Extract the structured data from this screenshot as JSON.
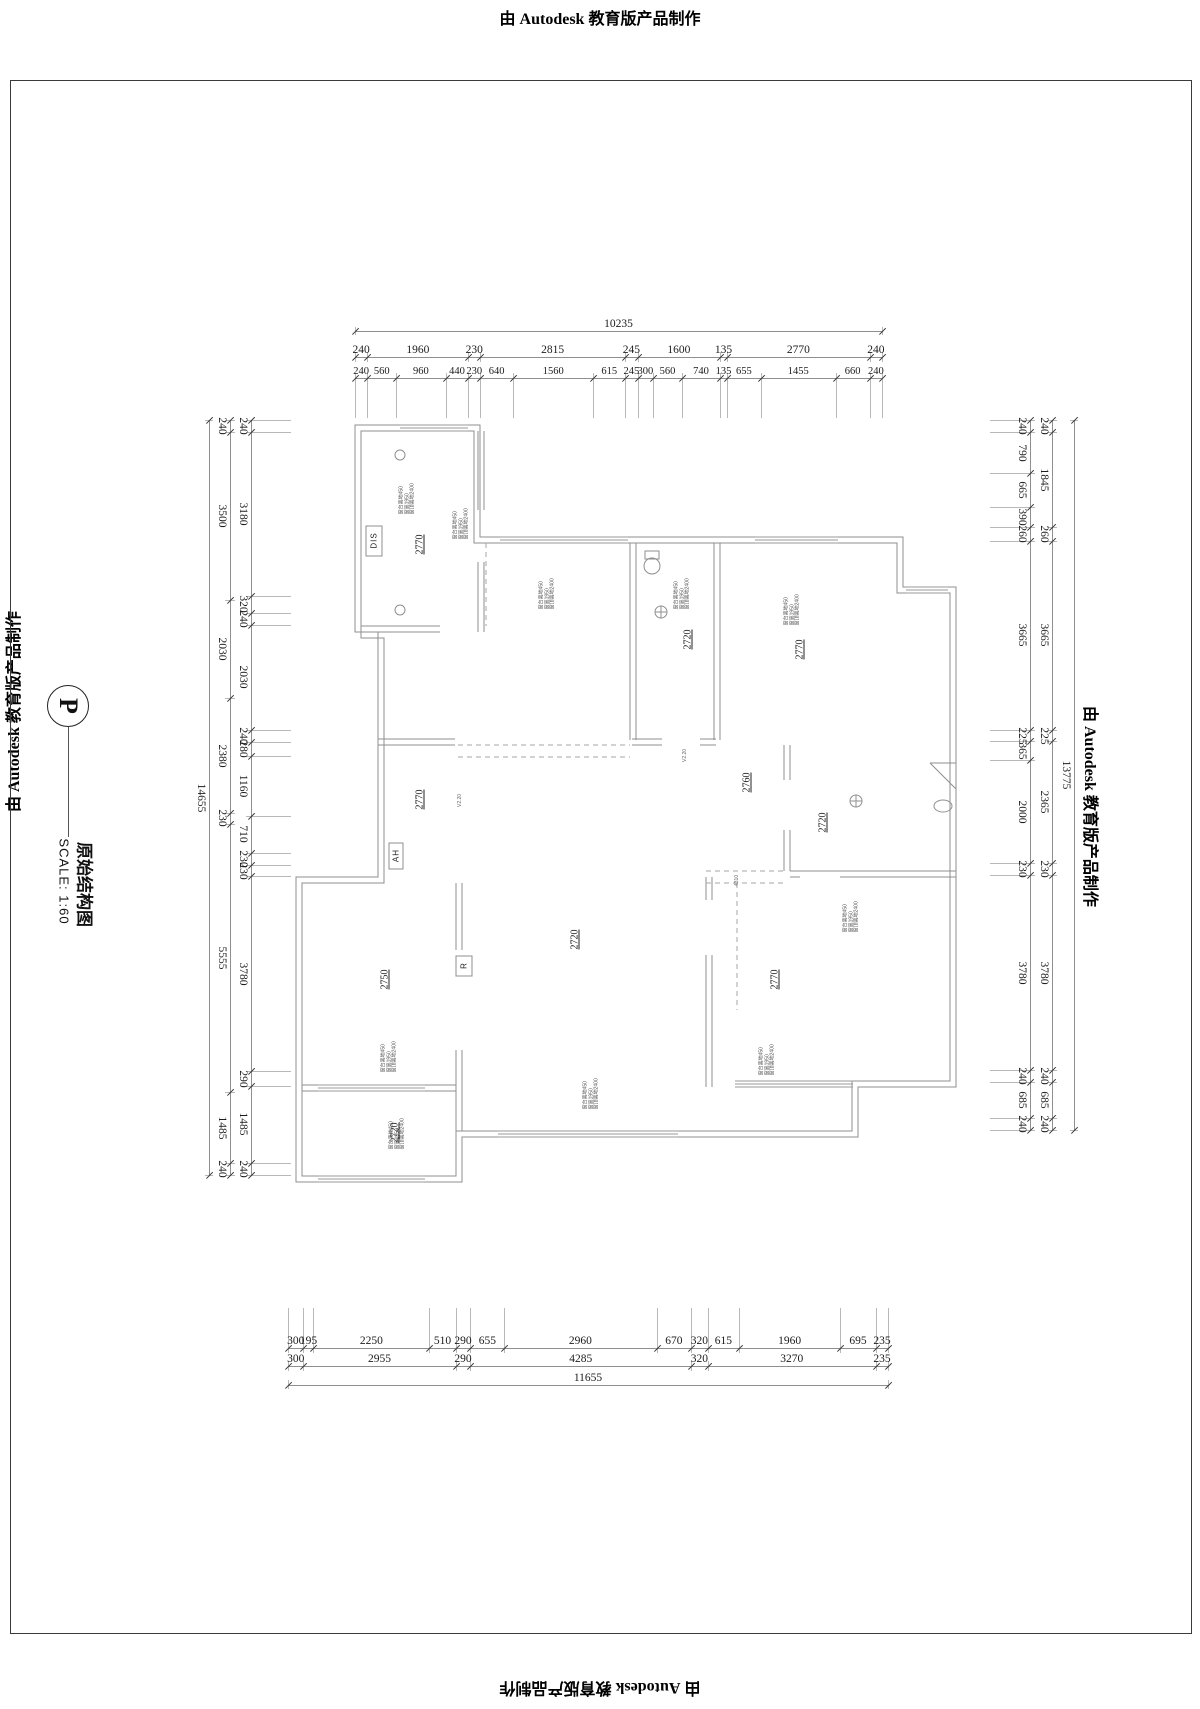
{
  "stamps": {
    "text": "由 Autodesk 教育版产品制作"
  },
  "title_block": {
    "letter": "P",
    "title": "原始结构图",
    "scale": "SCALE: 1:60"
  },
  "dims": {
    "chains": [
      {
        "id": "top-total",
        "dir": "h",
        "line": 331,
        "a": 355,
        "b": 882,
        "ext": [
          4,
          4
        ],
        "values": [
          10235
        ]
      },
      {
        "id": "top-row1",
        "dir": "h",
        "line": 357,
        "a": 355,
        "b": 882,
        "ext": [
          5,
          5
        ],
        "values": [
          240,
          1960,
          230,
          2815,
          245,
          1600,
          135,
          2770,
          240
        ]
      },
      {
        "id": "top-row2",
        "dir": "h",
        "line": 378,
        "a": 355,
        "b": 882,
        "ext": [
          5,
          40
        ],
        "small": true,
        "values": [
          240,
          560,
          960,
          440,
          230,
          640,
          1560,
          615,
          245,
          300,
          560,
          740,
          135,
          655,
          1455,
          660,
          240
        ]
      },
      {
        "id": "bottom-row1",
        "dir": "h",
        "line": 1348,
        "a": 288,
        "b": 888,
        "ext": [
          40,
          5
        ],
        "values": [
          300,
          195,
          2250,
          510,
          290,
          655,
          2960,
          670,
          320,
          615,
          1960,
          695,
          235
        ]
      },
      {
        "id": "bottom-row2",
        "dir": "h",
        "line": 1366,
        "a": 288,
        "b": 888,
        "ext": [
          5,
          5
        ],
        "values": [
          300,
          2955,
          290,
          4285,
          320,
          3270,
          235
        ]
      },
      {
        "id": "bottom-total",
        "dir": "h",
        "line": 1385,
        "a": 288,
        "b": 888,
        "ext": [
          5,
          4
        ],
        "values": [
          11655
        ]
      },
      {
        "id": "left-inner",
        "dir": "v",
        "line": 251,
        "a": 420,
        "b": 1175,
        "ext": [
          5,
          40
        ],
        "values": [
          240,
          3180,
          320,
          240,
          2030,
          240,
          280,
          1160,
          710,
          230,
          230,
          3780,
          290,
          1485,
          240
        ]
      },
      {
        "id": "left-outer",
        "dir": "v",
        "line": 230,
        "a": 420,
        "b": 1175,
        "ext": [
          5,
          5
        ],
        "values": [
          240,
          3500,
          2030,
          2380,
          230,
          5555,
          1485,
          240
        ]
      },
      {
        "id": "left-total",
        "dir": "v",
        "line": 209,
        "a": 420,
        "b": 1175,
        "ext": [
          4,
          4
        ],
        "values": [
          14655
        ]
      },
      {
        "id": "right-inner",
        "dir": "v",
        "line": 1030,
        "a": 420,
        "b": 1130,
        "ext": [
          40,
          5
        ],
        "values": [
          240,
          790,
          665,
          390,
          260,
          3665,
          225,
          365,
          2000,
          230,
          3780,
          240,
          685,
          240
        ]
      },
      {
        "id": "right-outer",
        "dir": "v",
        "line": 1052,
        "a": 420,
        "b": 1130,
        "ext": [
          5,
          5
        ],
        "values": [
          240,
          1845,
          260,
          3665,
          225,
          2365,
          230,
          3780,
          240,
          685,
          240
        ]
      },
      {
        "id": "right-total",
        "dir": "v",
        "line": 1074,
        "a": 420,
        "b": 1130,
        "ext": [
          4,
          4
        ],
        "values": [
          13775
        ]
      }
    ]
  },
  "plan": {
    "room_labels": [
      {
        "text": "2770",
        "x": 420,
        "y": 545
      },
      {
        "text": "2720",
        "x": 688,
        "y": 640
      },
      {
        "text": "2770",
        "x": 800,
        "y": 650
      },
      {
        "text": "2760",
        "x": 747,
        "y": 783
      },
      {
        "text": "2720",
        "x": 823,
        "y": 823
      },
      {
        "text": "2770",
        "x": 420,
        "y": 800
      },
      {
        "text": "2720",
        "x": 575,
        "y": 940
      },
      {
        "text": "2750",
        "x": 385,
        "y": 980
      },
      {
        "text": "2770",
        "x": 775,
        "y": 980
      },
      {
        "text": "2720",
        "x": 395,
        "y": 1133
      }
    ],
    "appliance_labels": [
      {
        "text": "DIS",
        "x": 374,
        "y": 541
      },
      {
        "text": "AH",
        "x": 396,
        "y": 856
      },
      {
        "text": "R",
        "x": 464,
        "y": 966
      }
    ],
    "annotations": [
      {
        "x": 408,
        "y": 487
      },
      {
        "x": 462,
        "y": 512
      },
      {
        "x": 548,
        "y": 582
      },
      {
        "x": 683,
        "y": 582
      },
      {
        "x": 793,
        "y": 598
      },
      {
        "x": 852,
        "y": 905
      },
      {
        "x": 768,
        "y": 1048
      },
      {
        "x": 592,
        "y": 1082
      },
      {
        "x": 390,
        "y": 1045
      },
      {
        "x": 398,
        "y": 1122
      }
    ],
    "annotation_lines": [
      "窗台离地450",
      "窗高1950",
      "窗顶离地2400"
    ],
    "micro_labels": [
      {
        "text": "V2.20",
        "x": 460,
        "y": 793
      },
      {
        "text": "V2.20",
        "x": 685,
        "y": 748
      },
      {
        "text": "4310",
        "x": 737,
        "y": 872
      }
    ]
  }
}
